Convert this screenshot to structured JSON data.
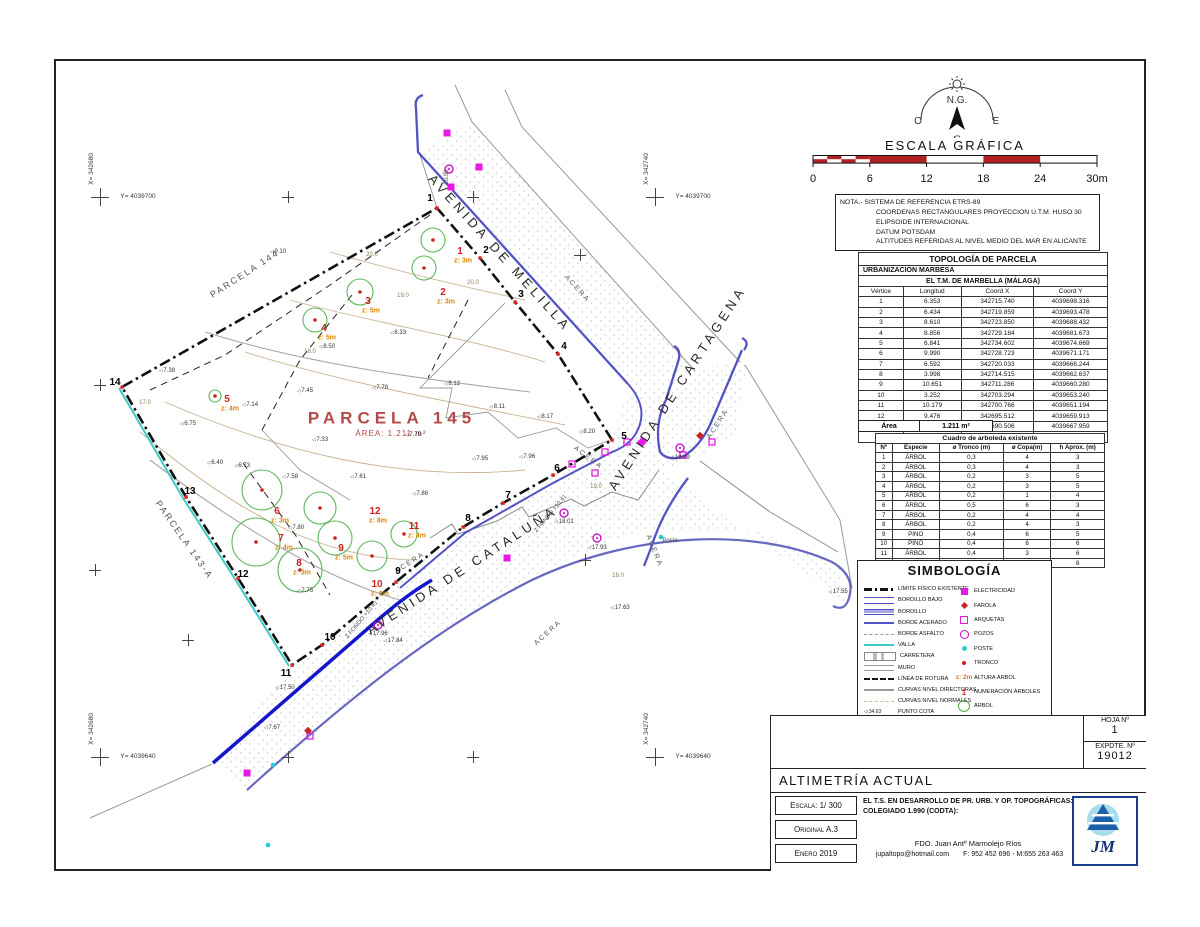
{
  "compass": {
    "ng": "N.G.",
    "o": "O",
    "e": "E",
    "s": "S"
  },
  "scale_bar": {
    "title": "ESCALA GRÁFICA",
    "ticks": [
      "0",
      "6",
      "12",
      "18",
      "24",
      "30m"
    ]
  },
  "nota": {
    "lines": [
      "NOTA.- SISTEMA DE REFERENCIA ETRS-89",
      "COORDENAS RECTANGULARES PROYECCION U.T.M. HUSO 30",
      "ELIPSOIDE  INTERNACIONAL",
      "DATUM POTSDAM",
      "ALTITUDES REFERIDAS AL NIVEL MEDIO DEL MAR EN ALICANTE"
    ]
  },
  "topology_table": {
    "title": "TOPOLOGÍA DE PARCELA",
    "subtitle1": "URBANIZACIÓN MARBESA",
    "subtitle2": "EL T.M. DE MARBELLA (MÁLAGA)",
    "columns": [
      "Vértice",
      "Longitud",
      "Coord X",
      "Coord Y"
    ],
    "rows": [
      [
        "1",
        "6.353",
        "342715.740",
        "4039698.316"
      ],
      [
        "2",
        "6.434",
        "342719.859",
        "4039693.478"
      ],
      [
        "3",
        "8.610",
        "342723.850",
        "4039688.432"
      ],
      [
        "4",
        "8.856",
        "342729.184",
        "4039681.673"
      ],
      [
        "5",
        "6.841",
        "342734.602",
        "4039674.669"
      ],
      [
        "6",
        "9.990",
        "342728.723",
        "4039671.171"
      ],
      [
        "7",
        "6.592",
        "342720.033",
        "4039666.244"
      ],
      [
        "8",
        "3.998",
        "342714.515",
        "4039662.637"
      ],
      [
        "9",
        "10.651",
        "342711.286",
        "4039660.280"
      ],
      [
        "10",
        "3.252",
        "342703.294",
        "4039653.240"
      ],
      [
        "11",
        "10.179",
        "342700.766",
        "4039651.194"
      ],
      [
        "12",
        "9.476",
        "342695.512",
        "4039659.913"
      ],
      [
        "13",
        "13.751",
        "342690.506",
        "4039667.959"
      ],
      [
        "14",
        "37.190",
        "342683.494",
        "4039679.787"
      ]
    ],
    "area_label": "Área",
    "area_value": "1.211 m²"
  },
  "trees_table": {
    "title": "Cuadro de arboleda existente",
    "columns": [
      "Nº",
      "Especie",
      "ø Tronco (m)",
      "ø Copa(m)",
      "h Aprox. (m)"
    ],
    "rows": [
      [
        "1",
        "ÁRBOL",
        "0,3",
        "4",
        "3"
      ],
      [
        "2",
        "ÁRBOL",
        "0,3",
        "4",
        "3"
      ],
      [
        "3",
        "ÁRBOL",
        "0,2",
        "3",
        "5"
      ],
      [
        "4",
        "ÁRBOL",
        "0,2",
        "3",
        "5"
      ],
      [
        "5",
        "ÁRBOL",
        "0,2",
        "1",
        "4"
      ],
      [
        "6",
        "ÁRBOL",
        "0,5",
        "6",
        "3"
      ],
      [
        "7",
        "ÁRBOL",
        "0,2",
        "4",
        "4"
      ],
      [
        "8",
        "ÁRBOL",
        "0,2",
        "4",
        "3"
      ],
      [
        "9",
        "PINO",
        "0,4",
        "6",
        "5"
      ],
      [
        "10",
        "PINO",
        "0,4",
        "6",
        "6"
      ],
      [
        "11",
        "ÁRBOL",
        "0,4",
        "3",
        "6"
      ],
      [
        "12",
        "PINO",
        "0,5",
        "8",
        "8"
      ]
    ]
  },
  "simbologia": {
    "title": "SIMBOLOGÍA",
    "left": [
      {
        "label": "LÍMITE FÍSICO EXISTENTE",
        "icon": "limite"
      },
      {
        "label": "BORDILLO BAJO",
        "icon": "bordillo-bajo"
      },
      {
        "label": "BORDILLO",
        "icon": "bordillo"
      },
      {
        "label": "BORDE ACERADO",
        "icon": "borde-acerado"
      },
      {
        "label": "BORDE ASFALTO",
        "icon": "borde-asfalto"
      },
      {
        "label": "VALLA",
        "icon": "valla"
      },
      {
        "label": "CARRETERA",
        "icon": "carretera"
      },
      {
        "label": "MURO",
        "icon": "muro"
      },
      {
        "label": "LÍNEA DE ROTURA",
        "icon": "linea-rotura"
      },
      {
        "label": "CURVAS NIVEL DIRECTORAS",
        "icon": "curvas-directoras"
      },
      {
        "label": "CURVAS NIVEL NORMALES",
        "icon": "curvas-normales"
      },
      {
        "label": "PUNTO COTA",
        "icon": "punto-cota",
        "key": "34.63"
      }
    ],
    "right": [
      {
        "label": "ELECTRICIDAD",
        "icon": "electricidad"
      },
      {
        "label": "FAROLA",
        "icon": "farola"
      },
      {
        "label": "ARQUETAS",
        "icon": "arquetas"
      },
      {
        "label": "POZOS",
        "icon": "pozos"
      },
      {
        "label": "POSTE",
        "icon": "poste"
      },
      {
        "label": "TRONCO",
        "icon": "tronco"
      },
      {
        "label": "ALTURA ÁRBOL",
        "icon": "altura-arbol",
        "key": "z: 2m"
      },
      {
        "label": "NUMERACIÓN ÁRBOLES",
        "icon": "numeracion",
        "key": "1"
      },
      {
        "label": "ÁRBOL",
        "icon": "arbol"
      }
    ]
  },
  "title_block": {
    "hoja_label": "HOJA Nº",
    "hoja_value": "1",
    "expdte_label": "EXPDTE. Nº",
    "expdte_value": "19012",
    "title": "ALTIMETRÍA ACTUAL",
    "escala": "Escala: 1/ 300",
    "original": "Original A.3",
    "fecha": "Enero 2019",
    "cert_line1": "EL T.S. EN DESARROLLO DE PR. URB. Y OP. TOPOGRÁFICAS:",
    "cert_line2": "COLEGIADO 1.990 (CODTA):",
    "fdo": "FDO. Juan Antº Marmolejo Ríos",
    "email": "jupaltopo@hotmail.com",
    "phones": "F: 952 452 696 - M:655 263 463",
    "logo_text": "JM"
  },
  "map": {
    "labels": [
      {
        "t": "AVENIDA DE MELILLA",
        "x": 500,
        "y": 253,
        "r": 48,
        "c": "l-street"
      },
      {
        "t": "AVENIDA DE CARTAGENA",
        "x": 677,
        "y": 388,
        "r": -57,
        "c": "l-street"
      },
      {
        "t": "AVENIDA DE CATALUÑA",
        "x": 462,
        "y": 570,
        "r": -33,
        "c": "l-street"
      },
      {
        "t": "PARCELA 144",
        "x": 245,
        "y": 274,
        "r": -33,
        "c": "l-parcel"
      },
      {
        "t": "PARCELA 143-A",
        "x": 184,
        "y": 540,
        "r": 55,
        "c": "l-parcel"
      },
      {
        "t": "PARCELA 145",
        "x": 392,
        "y": 418,
        "r": 0,
        "c": "l-parcel145"
      },
      {
        "t": "ÁREA: 1.211 m²",
        "x": 391,
        "y": 434,
        "r": 0,
        "c": "l-area145"
      },
      {
        "t": "ACERA",
        "x": 577,
        "y": 289,
        "r": 48,
        "c": "l-acera"
      },
      {
        "t": "ACERA",
        "x": 588,
        "y": 458,
        "r": 37,
        "c": "l-acera"
      },
      {
        "t": "ACERA",
        "x": 718,
        "y": 424,
        "r": -57,
        "c": "l-acera"
      },
      {
        "t": "ACERA",
        "x": 654,
        "y": 551,
        "r": 68,
        "c": "l-acera"
      },
      {
        "t": "ACERA",
        "x": 410,
        "y": 563,
        "r": -33,
        "c": "l-acera"
      },
      {
        "t": "ACERA",
        "x": 548,
        "y": 633,
        "r": -42,
        "c": "l-acera"
      },
      {
        "t": "Z FONDO +10.41",
        "x": 551,
        "y": 514,
        "r": -50,
        "c": "l-zfondo"
      },
      {
        "t": "Z FONDO +10.41",
        "x": 362,
        "y": 620,
        "r": -50,
        "c": "l-zfondo"
      },
      {
        "t": "Poste",
        "x": 670,
        "y": 541,
        "r": 0,
        "c": "l-misc"
      },
      {
        "t": "20.96",
        "x": 447,
        "y": 177,
        "r": -90,
        "c": "l-misc"
      },
      {
        "t": "20.0",
        "x": 372,
        "y": 255,
        "r": 0,
        "c": "l-contour"
      },
      {
        "t": "20.0",
        "x": 473,
        "y": 283,
        "r": 0,
        "c": "l-contour"
      },
      {
        "t": "19.0",
        "x": 403,
        "y": 296,
        "r": 0,
        "c": "l-contour"
      },
      {
        "t": "18.0",
        "x": 310,
        "y": 352,
        "r": 0,
        "c": "l-contour"
      },
      {
        "t": "17.0",
        "x": 145,
        "y": 403,
        "r": 0,
        "c": "l-contour"
      },
      {
        "t": "19.0",
        "x": 596,
        "y": 487,
        "r": 0,
        "c": "l-contour"
      },
      {
        "t": "18.0",
        "x": 618,
        "y": 576,
        "r": 0,
        "c": "l-contour"
      }
    ],
    "spots": [
      {
        "v": "9.10",
        "x": 278,
        "y": 252
      },
      {
        "v": "8.33",
        "x": 398,
        "y": 333
      },
      {
        "v": "8.50",
        "x": 327,
        "y": 347
      },
      {
        "v": "7.38",
        "x": 167,
        "y": 371
      },
      {
        "v": "7.45",
        "x": 305,
        "y": 391
      },
      {
        "v": "7.78",
        "x": 380,
        "y": 388
      },
      {
        "v": "8.12",
        "x": 452,
        "y": 384
      },
      {
        "v": "8.11",
        "x": 497,
        "y": 407
      },
      {
        "v": "8.17",
        "x": 545,
        "y": 417
      },
      {
        "v": "8.20",
        "x": 587,
        "y": 432
      },
      {
        "v": "7.14",
        "x": 250,
        "y": 405
      },
      {
        "v": "6.75",
        "x": 188,
        "y": 424
      },
      {
        "v": "7.33",
        "x": 320,
        "y": 440
      },
      {
        "v": "7.79",
        "x": 413,
        "y": 435
      },
      {
        "v": "6.40",
        "x": 215,
        "y": 463
      },
      {
        "v": "6.73",
        "x": 242,
        "y": 466
      },
      {
        "v": "7.58",
        "x": 290,
        "y": 477
      },
      {
        "v": "7.95",
        "x": 480,
        "y": 459
      },
      {
        "v": "7.96",
        "x": 527,
        "y": 457
      },
      {
        "v": "7.61",
        "x": 358,
        "y": 477
      },
      {
        "v": "7.86",
        "x": 420,
        "y": 494
      },
      {
        "v": "7.80",
        "x": 296,
        "y": 528
      },
      {
        "v": "7.75",
        "x": 305,
        "y": 591
      },
      {
        "v": "17.50",
        "x": 285,
        "y": 688
      },
      {
        "v": "7.67",
        "x": 272,
        "y": 728
      },
      {
        "v": "17.84",
        "x": 393,
        "y": 641
      },
      {
        "v": "17.55",
        "x": 838,
        "y": 592
      },
      {
        "v": "18.09",
        "x": 680,
        "y": 458
      },
      {
        "v": "18.01",
        "x": 564,
        "y": 522
      },
      {
        "v": "17.93",
        "x": 597,
        "y": 548
      },
      {
        "v": "17.96",
        "x": 378,
        "y": 634
      },
      {
        "v": "17.63",
        "x": 620,
        "y": 608
      }
    ],
    "vertices": [
      {
        "n": "1",
        "x": 430,
        "y": 199
      },
      {
        "n": "2",
        "x": 486,
        "y": 251
      },
      {
        "n": "3",
        "x": 521,
        "y": 295
      },
      {
        "n": "4",
        "x": 564,
        "y": 347
      },
      {
        "n": "5",
        "x": 624,
        "y": 437
      },
      {
        "n": "6",
        "x": 557,
        "y": 469
      },
      {
        "n": "7",
        "x": 508,
        "y": 496
      },
      {
        "n": "8",
        "x": 468,
        "y": 519
      },
      {
        "n": "9",
        "x": 398,
        "y": 572
      },
      {
        "n": "10",
        "x": 330,
        "y": 638
      },
      {
        "n": "11",
        "x": 286,
        "y": 674
      },
      {
        "n": "12",
        "x": 243,
        "y": 575
      },
      {
        "n": "13",
        "x": 190,
        "y": 492
      },
      {
        "n": "14",
        "x": 115,
        "y": 383
      }
    ],
    "trees": [
      {
        "n": "1",
        "z": "z: 3m",
        "x": 460,
        "y": 252
      },
      {
        "n": "2",
        "z": "z: 3m",
        "x": 443,
        "y": 293
      },
      {
        "n": "3",
        "z": "z: 5m",
        "x": 368,
        "y": 302
      },
      {
        "n": "4",
        "z": "z: 5m",
        "x": 324,
        "y": 329
      },
      {
        "n": "5",
        "z": "z: 4m",
        "x": 227,
        "y": 400
      },
      {
        "n": "6",
        "z": "z: 3m",
        "x": 277,
        "y": 512
      },
      {
        "n": "7",
        "z": "z: 4m",
        "x": 281,
        "y": 539
      },
      {
        "n": "8",
        "z": "z: 3m",
        "x": 299,
        "y": 564
      },
      {
        "n": "9",
        "z": "z: 5m",
        "x": 341,
        "y": 549
      },
      {
        "n": "10",
        "z": "z: 6m",
        "x": 377,
        "y": 585
      },
      {
        "n": "11",
        "z": "z: 4m",
        "x": 414,
        "y": 527
      },
      {
        "n": "12",
        "z": "z: 8m",
        "x": 375,
        "y": 512
      }
    ],
    "crosses": [
      {
        "x": 100,
        "y": 197,
        "b": 1,
        "xl": "X= 342680",
        "yl": "Y= 4039700"
      },
      {
        "x": 655,
        "y": 197,
        "b": 1,
        "xl": "X= 342740",
        "yl": "Y= 4039700"
      },
      {
        "x": 100,
        "y": 757,
        "b": 1,
        "xl": "X= 342680",
        "yl": "Y= 4039640"
      },
      {
        "x": 655,
        "y": 757,
        "b": 1,
        "xl": "X= 342740",
        "yl": "Y= 4039640"
      },
      {
        "x": 288,
        "y": 197
      },
      {
        "x": 473,
        "y": 197
      },
      {
        "x": 100,
        "y": 385
      },
      {
        "x": 95,
        "y": 570
      },
      {
        "x": 288,
        "y": 757
      },
      {
        "x": 473,
        "y": 757
      },
      {
        "x": 580,
        "y": 255
      },
      {
        "x": 188,
        "y": 640
      },
      {
        "x": 585,
        "y": 560
      }
    ]
  }
}
